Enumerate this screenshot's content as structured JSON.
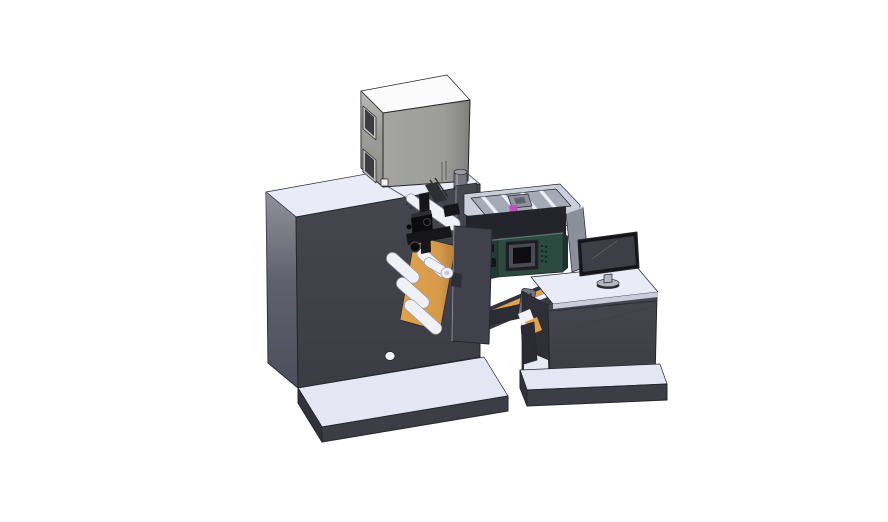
{
  "scene": {
    "title": "Isometric 3D CAD render of an industrial label printing line: main press cabinet with top electrical box, web rollers and print mechanism, inkjet engine with supply tray, transfer conveyor bridge, and an operator desk with a monitor",
    "background": "#ffffff"
  },
  "colors": {
    "background": "#ffffff",
    "outline": "#26262c",
    "topSurface": "#e9ebf6",
    "bodyFront": "#46464f",
    "bodySide": "#4d4f5c",
    "platformTop": "#e4e7f3",
    "platformSkirt": "#3d3d46",
    "platformSkirtDark": "#32323a",
    "cabTop": "#fbfbfc",
    "cabFront": "#a4a4a0",
    "cabSide": "#90908c",
    "cabFrame": "#c2c2be",
    "cabWindow": "#3c3d43",
    "cabSquare": "#f2f2f0",
    "knobBody": "#77777d",
    "knobTop": "#9a9aa0",
    "knobBand": "#26262b",
    "trayWall": "#cbcfda",
    "trayFloor": "#a5aab7",
    "trayStrip": "#edeff6",
    "trayBlock": "#8e939f",
    "trayBlockDark": "#5f646e",
    "magenta": "#c44fc0",
    "shadowBand": "#24242d",
    "greenFront": "#2d4a41",
    "greenSide": "#223b34",
    "greenDark": "#1c332d",
    "screenBezel": "#1e1e23",
    "screenMid": "#4a4a52",
    "screenBlack": "#0e0e12",
    "clampBlack": "#141418",
    "ventDot": "#152420",
    "convRail": "#33333c",
    "convRail2": "#3a3a42",
    "orange": "#e2a24c",
    "rollerWhite": "#eff1f6",
    "beam": "#2d2d35",
    "plate": "#71757f",
    "plateHole": "#2b2b31",
    "leg": "#2b2b33",
    "deskInterior": "#2f2f38",
    "deskFloor": "#e8eaf3",
    "topEdgeStrip": "#c9cdd9",
    "panelGray": "#8b8f9a",
    "monBezel": "#15151a",
    "monScreen": "#3e3e46",
    "standGray": "#b3b7c1",
    "pillar": "#41414b",
    "pillarNotch": "#2e2e36",
    "mechBlack": "#17171b",
    "mechDark": "#0c0c0f",
    "mechMid": "#2e2e35",
    "mechTop": "#2e2e34",
    "holeWhite": "#f0f1f6",
    "rollerCore": "#c6c9d4"
  }
}
